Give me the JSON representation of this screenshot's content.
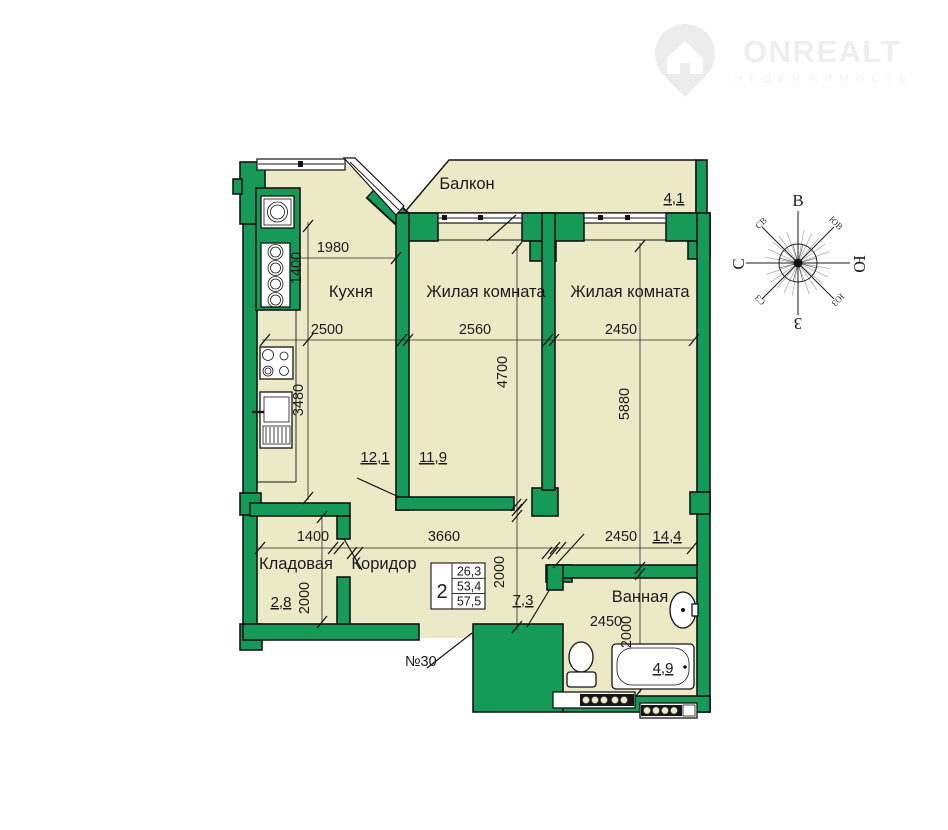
{
  "logo": {
    "title": "ONREALT",
    "subtitle": "НЕДВИЖИМОСТЬ"
  },
  "plan": {
    "apartment_number": "№30",
    "rooms": {
      "balcony": {
        "label": "Балкон",
        "area": "4,1"
      },
      "kitchen": {
        "label": "Кухня",
        "area": "12,1"
      },
      "living1": {
        "label": "Жилая комната",
        "area": "11,9"
      },
      "living2": {
        "label": "Жилая комната",
        "area": "14,4"
      },
      "storage": {
        "label": "Кладовая",
        "area": "2,8"
      },
      "corridor": {
        "label": "Коридор",
        "area": "7,3"
      },
      "bathroom": {
        "label": "Ванная",
        "area": "4,9"
      }
    },
    "dims": {
      "kitchen_top": "1980",
      "kitchen_upper_h": "1400",
      "kitchen_w": "2500",
      "living1_w": "2560",
      "living2_w": "2450",
      "living1_h": "4700",
      "living2_h": "5880",
      "kitchen_lower_h": "3480",
      "storage_w": "1400",
      "corridor_w": "3660",
      "living2_w_lower": "2450",
      "storage_h": "2000",
      "corridor_h": "2000",
      "bathroom_w": "2450",
      "bathroom_h": "2000"
    },
    "info_table": {
      "rooms_count": "2",
      "living_area": "26,3",
      "area_wo_balcony": "53,4",
      "total_area": "57,5"
    }
  },
  "compass": {
    "east": "В",
    "south": "Ю",
    "west": "З",
    "north": "С",
    "ne": "СВ",
    "se": "ЮВ",
    "sw": "ЮЗ",
    "nw": "СЗ"
  },
  "colors": {
    "wall_green": "#169a58",
    "floor_beige": "#ece9c6",
    "line": "#141414",
    "logo_gray": "#eeeeee"
  }
}
